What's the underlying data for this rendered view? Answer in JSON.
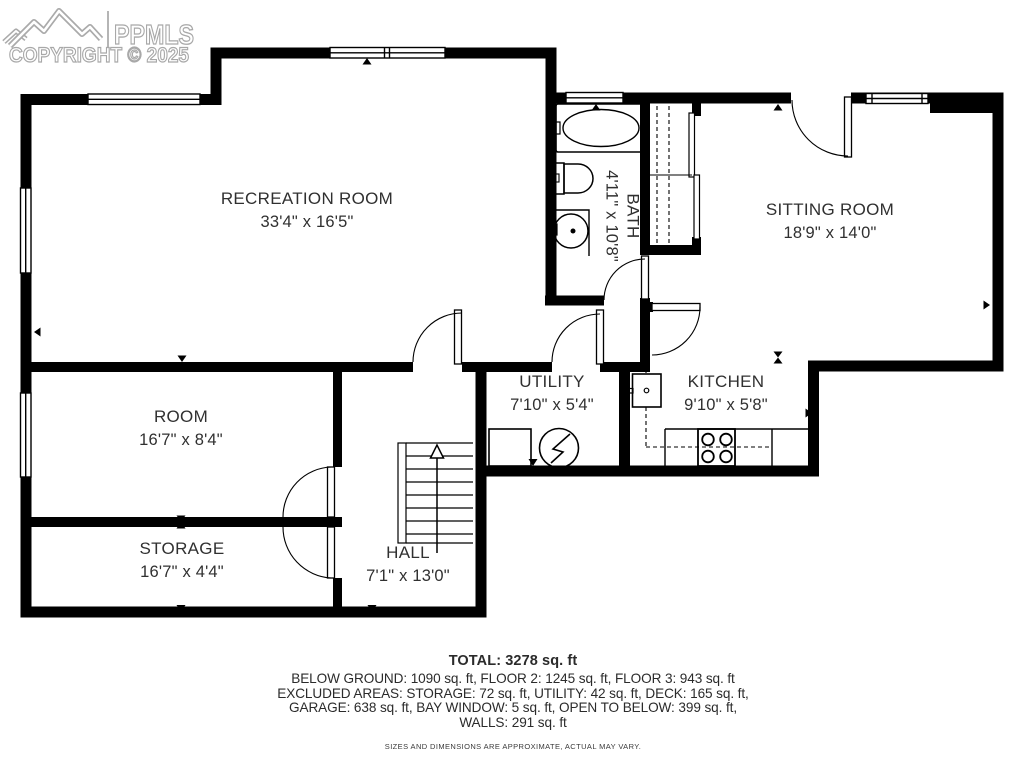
{
  "watermark": {
    "brand": "PPMLS",
    "copyright": "COPYRIGHT © 2025",
    "logo_icon": "mountain-range-icon",
    "color": "#ababab"
  },
  "rooms": {
    "recreation": {
      "name": "RECREATION ROOM",
      "dims": "33'4\" x 16'5\""
    },
    "sitting": {
      "name": "SITTING ROOM",
      "dims": "18'9\" x 14'0\""
    },
    "bath": {
      "name": "BATH",
      "dims": "4'11\" x 10'8\""
    },
    "room": {
      "name": "ROOM",
      "dims": "16'7\" x 8'4\""
    },
    "utility": {
      "name": "UTILITY",
      "dims": "7'10\" x 5'4\""
    },
    "kitchen": {
      "name": "KITCHEN",
      "dims": "9'10\" x 5'8\""
    },
    "storage": {
      "name": "STORAGE",
      "dims": "16'7\" x 4'4\""
    },
    "hall": {
      "name": "HALL",
      "dims": "7'1\" x 13'0\""
    }
  },
  "summary": {
    "total": "TOTAL: 3278 sq. ft",
    "lines": [
      "BELOW GROUND: 1090 sq. ft, FLOOR 2: 1245 sq. ft, FLOOR 3: 943 sq. ft",
      "EXCLUDED AREAS: STORAGE: 72 sq. ft, UTILITY: 42 sq. ft, DECK: 165 sq. ft,",
      "GARAGE: 638 sq. ft, BAY WINDOW: 5 sq. ft, OPEN TO BELOW: 399 sq. ft,",
      "WALLS: 291 sq. ft"
    ],
    "disclaimer": "SIZES AND DIMENSIONS ARE APPROXIMATE, ACTUAL MAY VARY."
  },
  "plan": {
    "wall_color": "#000000",
    "stair_direction": "up"
  }
}
